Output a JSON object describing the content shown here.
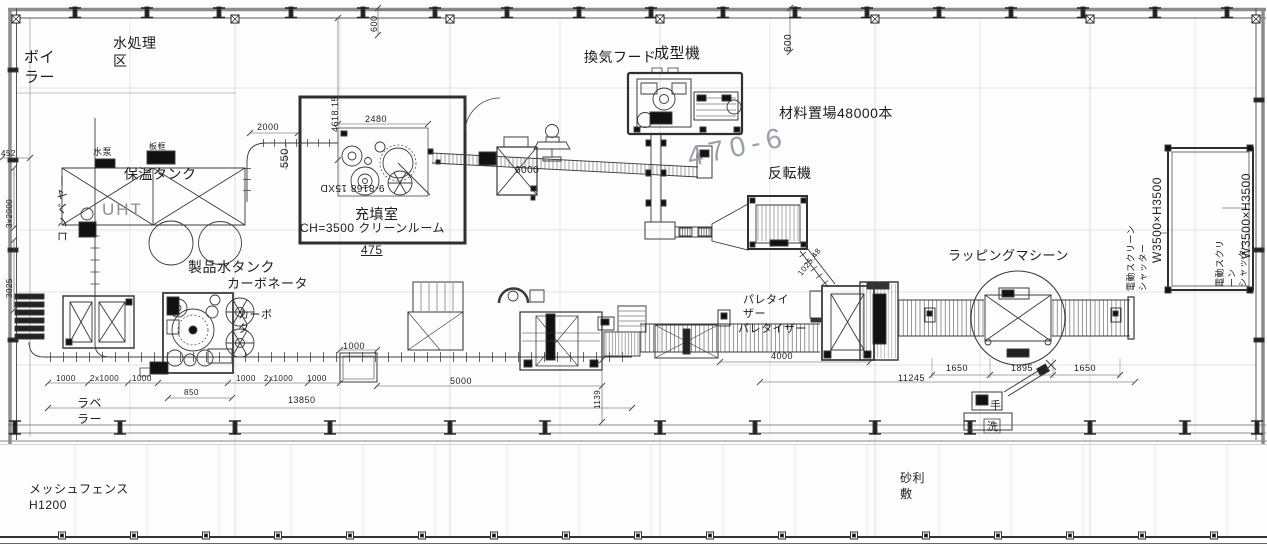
{
  "drawing": {
    "type": "factory-layout-plan",
    "background": "#fdfdfd",
    "line_color": "#3a3a3a",
    "wall_color": "#8c8c8c",
    "grid_color": "#c9c9c9",
    "ghost_color": "#9aa0a8"
  },
  "labels": [
    {
      "name": "boiler-label",
      "text": "ボイ\nラー",
      "x": 24,
      "y": 48,
      "fs": 15
    },
    {
      "name": "water-treatment-label",
      "text": "水処理\n区",
      "x": 113,
      "y": 34,
      "fs": 14
    },
    {
      "name": "dim-4618",
      "text": "4618.15",
      "x": 330,
      "y": 132,
      "fs": 9,
      "rot": -90
    },
    {
      "name": "dim-600-a",
      "text": "600",
      "x": 369,
      "y": 32,
      "fs": 9,
      "rot": -90
    },
    {
      "name": "dim-600-b",
      "text": "600",
      "x": 782,
      "y": 52,
      "fs": 10,
      "rot": -90
    },
    {
      "name": "water-pump-label",
      "text": "水泵",
      "x": 93,
      "y": 147,
      "fs": 9
    },
    {
      "name": "panel-label",
      "text": "板框",
      "x": 149,
      "y": 142,
      "fs": 8
    },
    {
      "name": "insulated-tank-label",
      "text": "保温タンク",
      "x": 124,
      "y": 165,
      "fs": 14
    },
    {
      "name": "uht-label",
      "text": "UHT",
      "x": 102,
      "y": 199,
      "fs": 17,
      "color": "#8f8f8f",
      "ls": 2
    },
    {
      "name": "conveyor-vertical-label",
      "text": "コンベヤー",
      "x": 56,
      "y": 242,
      "fs": 11,
      "rot": -90,
      "ls": 3
    },
    {
      "name": "dim-2000",
      "text": "2000",
      "x": 257,
      "y": 122,
      "fs": 9
    },
    {
      "name": "dim-550",
      "text": "550",
      "x": 278,
      "y": 168,
      "fs": 11,
      "rot": -90
    },
    {
      "name": "dim-2480",
      "text": "2480",
      "x": 365,
      "y": 114,
      "fs": 9
    },
    {
      "name": "mirrored-machine-text",
      "text": "9-8168 15XD",
      "x": 320,
      "y": 181,
      "fs": 10,
      "rot": 180
    },
    {
      "name": "filling-room-label",
      "text": "充填室",
      "x": 355,
      "y": 205,
      "fs": 14
    },
    {
      "name": "cleanroom-label",
      "text": "CH=3500 クリーンルーム",
      "x": 300,
      "y": 221,
      "fs": 12
    },
    {
      "name": "dim-475",
      "text": "475",
      "x": 361,
      "y": 243,
      "fs": 12,
      "underline": true
    },
    {
      "name": "dim-6000",
      "text": "6000",
      "x": 515,
      "y": 164,
      "fs": 10
    },
    {
      "name": "vent-hood-label",
      "text": "換気フード",
      "x": 584,
      "y": 48,
      "fs": 14
    },
    {
      "name": "molding-machine-label",
      "text": "成型機",
      "x": 654,
      "y": 44,
      "fs": 15
    },
    {
      "name": "material-storage-label",
      "text": "材料置場48000本",
      "x": 779,
      "y": 104,
      "fs": 14
    },
    {
      "name": "handwritten-470-6",
      "text": "470-6",
      "x": 684,
      "y": 140,
      "fs": 28,
      "color": "#9aa0a8",
      "rot": -12,
      "ls": 6
    },
    {
      "name": "inverter-label",
      "text": "反転機",
      "x": 768,
      "y": 164,
      "fs": 14
    },
    {
      "name": "dim-1025",
      "text": "1025.48",
      "x": 796,
      "y": 272,
      "fs": 8,
      "rot": -52
    },
    {
      "name": "wrapping-machine-label",
      "text": "ラッピングマシーン",
      "x": 948,
      "y": 248,
      "fs": 13
    },
    {
      "name": "product-water-tank-label",
      "text": "製品水タンク",
      "x": 188,
      "y": 258,
      "fs": 14
    },
    {
      "name": "carbonator-label",
      "text": "カーボネータ",
      "x": 227,
      "y": 276,
      "fs": 13
    },
    {
      "name": "carbo-ta-label",
      "text": "カーボ\nタ",
      "x": 238,
      "y": 308,
      "fs": 11
    },
    {
      "name": "palletizer-label-2line",
      "text": "パレタイ\nザー",
      "x": 743,
      "y": 293,
      "fs": 11
    },
    {
      "name": "palletizer-label",
      "text": "パレタイザー",
      "x": 738,
      "y": 322,
      "fs": 11
    },
    {
      "name": "dim-4000",
      "text": "4000",
      "x": 771,
      "y": 351,
      "fs": 9
    },
    {
      "name": "dim-1650-a",
      "text": "1650",
      "x": 946,
      "y": 363,
      "fs": 9
    },
    {
      "name": "dim-1895",
      "text": "1895",
      "x": 1011,
      "y": 363,
      "fs": 9
    },
    {
      "name": "dim-1650-b",
      "text": "1650",
      "x": 1074,
      "y": 363,
      "fs": 9
    },
    {
      "name": "dim-11245",
      "text": "11245",
      "x": 898,
      "y": 373,
      "fs": 9
    },
    {
      "name": "hand-label",
      "text": "手",
      "x": 990,
      "y": 399,
      "fs": 11
    },
    {
      "name": "wash-label",
      "text": "洗",
      "x": 987,
      "y": 420,
      "fs": 11
    },
    {
      "name": "shutter-label-left",
      "text": "電動スクリーン\nシャッター",
      "x": 1126,
      "y": 291,
      "fs": 9,
      "rot": -90
    },
    {
      "name": "shutter-size-left",
      "text": "W3500×H3500",
      "x": 1150,
      "y": 263,
      "fs": 12,
      "rot": -90
    },
    {
      "name": "shutter-label-right",
      "text": "電動スクリーン\nシャッター",
      "x": 1215,
      "y": 287,
      "fs": 9,
      "rot": -90
    },
    {
      "name": "shutter-size-right",
      "text": "W3500×H3500",
      "x": 1239,
      "y": 259,
      "fs": 12,
      "rot": -90
    },
    {
      "name": "dim-1000-a",
      "text": "1000",
      "x": 56,
      "y": 374,
      "fs": 8
    },
    {
      "name": "dim-2x1000-a",
      "text": "2x1000",
      "x": 90,
      "y": 374,
      "fs": 8
    },
    {
      "name": "dim-1000-b",
      "text": "1000",
      "x": 132,
      "y": 374,
      "fs": 8
    },
    {
      "name": "dim-1000-c",
      "text": "1000",
      "x": 236,
      "y": 374,
      "fs": 8
    },
    {
      "name": "dim-2x1000-b",
      "text": "2x1000",
      "x": 264,
      "y": 374,
      "fs": 8
    },
    {
      "name": "dim-1000-d",
      "text": "1000",
      "x": 307,
      "y": 374,
      "fs": 8
    },
    {
      "name": "dim-850",
      "text": "850",
      "x": 184,
      "y": 388,
      "fs": 8
    },
    {
      "name": "dim-1000-box",
      "text": "1000",
      "x": 343,
      "y": 341,
      "fs": 9
    },
    {
      "name": "dim-5000",
      "text": "5000",
      "x": 450,
      "y": 376,
      "fs": 9
    },
    {
      "name": "dim-13850",
      "text": "13850",
      "x": 288,
      "y": 395,
      "fs": 9
    },
    {
      "name": "dim-1139",
      "text": "1139",
      "x": 593,
      "y": 409,
      "fs": 8,
      "rot": -90
    },
    {
      "name": "labeler-label",
      "text": "ラベ\nラー",
      "x": 77,
      "y": 396,
      "fs": 12
    },
    {
      "name": "mesh-fence-label",
      "text": "メッシュフェンス\nH1200",
      "x": 29,
      "y": 482,
      "fs": 12
    },
    {
      "name": "gravel-label",
      "text": "砂利\n敷",
      "x": 900,
      "y": 471,
      "fs": 12
    },
    {
      "name": "dim-452",
      "text": "452",
      "x": 1,
      "y": 149,
      "fs": 8
    },
    {
      "name": "dim-3x2000",
      "text": "3x2000",
      "x": 5,
      "y": 228,
      "fs": 8,
      "rot": -90
    },
    {
      "name": "dim-3025",
      "text": "3025",
      "x": 5,
      "y": 298,
      "fs": 8,
      "rot": -90
    }
  ]
}
